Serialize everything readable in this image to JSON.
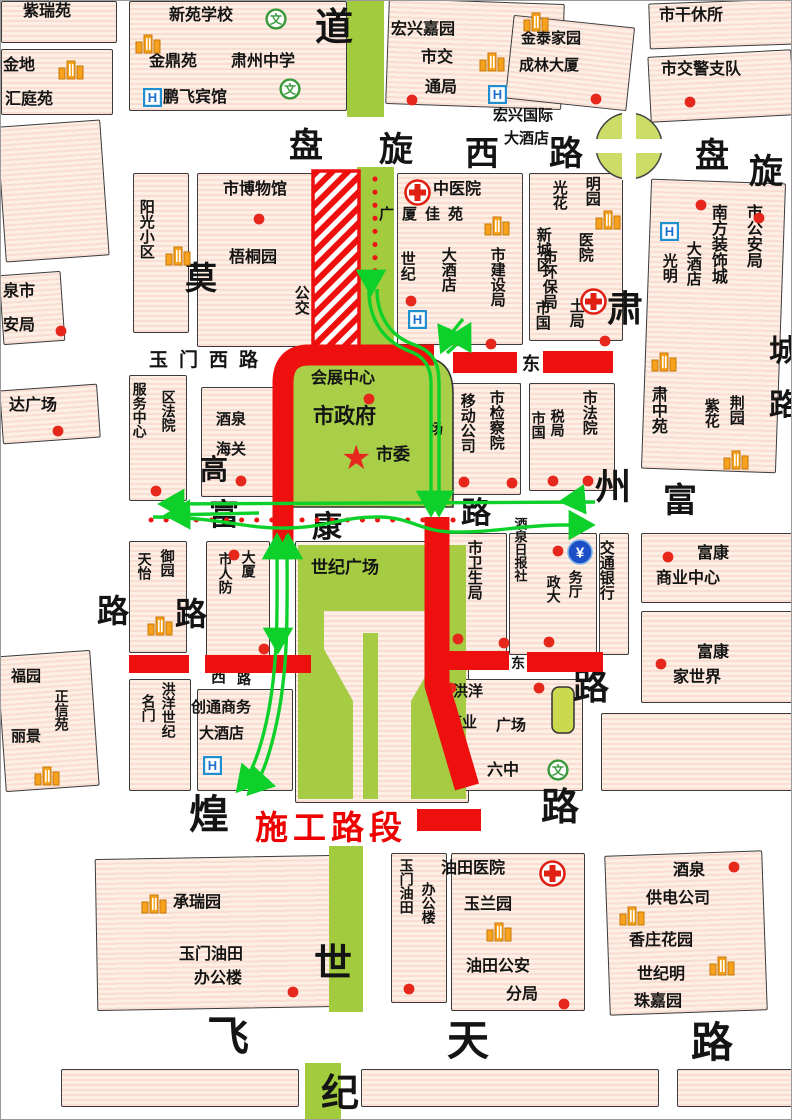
{
  "legend": {
    "label": "施工路段"
  },
  "colors": {
    "construction": "#ee0f0f",
    "detour": "#0ed02a",
    "block_fill": "#fdefe4",
    "green_area": "#a6cc44",
    "poi_dot": "#e5281b"
  },
  "map": {
    "labels": [
      {
        "t": "紫瑞苑",
        "x": 22,
        "y": 2,
        "s": 16
      },
      {
        "t": "金地",
        "x": 2,
        "y": 56,
        "s": 16
      },
      {
        "t": "汇庭苑",
        "x": 4,
        "y": 90,
        "s": 16
      },
      {
        "t": "新苑学校",
        "x": 168,
        "y": 6,
        "s": 16
      },
      {
        "t": "金鼎苑",
        "x": 148,
        "y": 52,
        "s": 16
      },
      {
        "t": "肃州中学",
        "x": 230,
        "y": 52,
        "s": 16
      },
      {
        "t": "鹏飞宾馆",
        "x": 162,
        "y": 88,
        "s": 16
      },
      {
        "t": "宏兴嘉园",
        "x": 390,
        "y": 20,
        "s": 16
      },
      {
        "t": "市交",
        "x": 420,
        "y": 48,
        "s": 16
      },
      {
        "t": "通局",
        "x": 424,
        "y": 78,
        "s": 16
      },
      {
        "t": "金泰家园",
        "x": 520,
        "y": 30,
        "s": 15
      },
      {
        "t": "成林大厦",
        "x": 518,
        "y": 57,
        "s": 15
      },
      {
        "t": "市干休所",
        "x": 658,
        "y": 6,
        "s": 16
      },
      {
        "t": "市交警支队",
        "x": 660,
        "y": 60,
        "s": 16
      },
      {
        "t": "宏兴国际",
        "x": 492,
        "y": 107,
        "s": 15
      },
      {
        "t": "大酒店",
        "x": 503,
        "y": 130,
        "s": 15
      },
      {
        "t": "道",
        "x": 314,
        "y": 6,
        "s": 38
      },
      {
        "t": "盘",
        "x": 288,
        "y": 126,
        "s": 34
      },
      {
        "t": "旋",
        "x": 378,
        "y": 130,
        "s": 34
      },
      {
        "t": "西",
        "x": 464,
        "y": 134,
        "s": 34
      },
      {
        "t": "路",
        "x": 548,
        "y": 134,
        "s": 34
      },
      {
        "t": "盘",
        "x": 694,
        "y": 136,
        "s": 34
      },
      {
        "t": "旋",
        "x": 748,
        "y": 152,
        "s": 34
      },
      {
        "t": "市博物馆",
        "x": 222,
        "y": 180,
        "s": 16
      },
      {
        "t": "阳光小区",
        "x": 136,
        "y": 198,
        "s": 15,
        "v": 1
      },
      {
        "t": "梧桐园",
        "x": 228,
        "y": 248,
        "s": 16
      },
      {
        "t": "莫",
        "x": 184,
        "y": 260,
        "s": 32
      },
      {
        "t": "公交",
        "x": 291,
        "y": 284,
        "s": 15,
        "v": 1
      },
      {
        "t": "资中",
        "x": 339,
        "y": 284,
        "s": 15,
        "v": 1
      },
      {
        "t": "中医院",
        "x": 432,
        "y": 180,
        "s": 16
      },
      {
        "t": "广厦佳苑",
        "x": 378,
        "y": 206,
        "s": 15,
        "ls": 8
      },
      {
        "t": "世纪",
        "x": 397,
        "y": 250,
        "s": 15,
        "v": 1
      },
      {
        "t": "大酒店",
        "x": 438,
        "y": 246,
        "s": 15,
        "v": 1
      },
      {
        "t": "市建设局",
        "x": 487,
        "y": 246,
        "s": 15,
        "v": 1
      },
      {
        "t": "市环保局",
        "x": 539,
        "y": 248,
        "s": 15,
        "v": 1
      },
      {
        "t": "明园",
        "x": 582,
        "y": 175,
        "s": 15,
        "v": 1
      },
      {
        "t": "光花",
        "x": 549,
        "y": 179,
        "s": 15,
        "v": 1
      },
      {
        "t": "医院",
        "x": 575,
        "y": 231,
        "s": 15,
        "v": 1
      },
      {
        "t": "新城区",
        "x": 533,
        "y": 226,
        "s": 15,
        "v": 1
      },
      {
        "t": "土局",
        "x": 566,
        "y": 297,
        "s": 15,
        "v": 1
      },
      {
        "t": "市国",
        "x": 532,
        "y": 299,
        "s": 15,
        "v": 1
      },
      {
        "t": "市公安局",
        "x": 742,
        "y": 203,
        "s": 16,
        "v": 1
      },
      {
        "t": "南方装饰城",
        "x": 707,
        "y": 203,
        "s": 16,
        "v": 1
      },
      {
        "t": "大酒店",
        "x": 683,
        "y": 240,
        "s": 15,
        "v": 1
      },
      {
        "t": "光明",
        "x": 659,
        "y": 252,
        "s": 15,
        "v": 1
      },
      {
        "t": "肃中苑",
        "x": 647,
        "y": 385,
        "s": 16,
        "v": 1
      },
      {
        "t": "荆园",
        "x": 726,
        "y": 394,
        "s": 15,
        "v": 1
      },
      {
        "t": "紫花",
        "x": 701,
        "y": 397,
        "s": 15,
        "v": 1
      },
      {
        "t": "城",
        "x": 768,
        "y": 334,
        "s": 30
      },
      {
        "t": "路",
        "x": 768,
        "y": 388,
        "s": 30
      },
      {
        "t": "肃",
        "x": 606,
        "y": 288,
        "s": 36
      },
      {
        "t": "州",
        "x": 594,
        "y": 466,
        "s": 36
      },
      {
        "t": "路",
        "x": 572,
        "y": 666,
        "s": 36
      },
      {
        "t": "富",
        "x": 662,
        "y": 481,
        "s": 34
      },
      {
        "t": "玉门西路",
        "x": 148,
        "y": 349,
        "s": 19,
        "ls": 11
      },
      {
        "t": "东",
        "x": 521,
        "y": 353,
        "s": 18
      },
      {
        "t": "泉市",
        "x": 2,
        "y": 282,
        "s": 16
      },
      {
        "t": "安局",
        "x": 2,
        "y": 316,
        "s": 16
      },
      {
        "t": "达广场",
        "x": 8,
        "y": 396,
        "s": 16
      },
      {
        "t": "服务中心",
        "x": 130,
        "y": 381,
        "s": 14,
        "v": 1
      },
      {
        "t": "区法院",
        "x": 159,
        "y": 389,
        "s": 14,
        "v": 1
      },
      {
        "t": "酒泉",
        "x": 215,
        "y": 411,
        "s": 15
      },
      {
        "t": "海关",
        "x": 215,
        "y": 441,
        "s": 15
      },
      {
        "t": "会展中心",
        "x": 310,
        "y": 369,
        "s": 16
      },
      {
        "t": "市政府",
        "x": 312,
        "y": 404,
        "s": 21
      },
      {
        "t": "市委",
        "x": 375,
        "y": 444,
        "s": 17
      },
      {
        "t": "场",
        "x": 428,
        "y": 421,
        "s": 14
      },
      {
        "t": "移动公司",
        "x": 457,
        "y": 392,
        "s": 15,
        "v": 1
      },
      {
        "t": "市检察院",
        "x": 486,
        "y": 389,
        "s": 15,
        "v": 1
      },
      {
        "t": "市国",
        "x": 529,
        "y": 410,
        "s": 14,
        "v": 1
      },
      {
        "t": "税局",
        "x": 548,
        "y": 408,
        "s": 14,
        "v": 1
      },
      {
        "t": "市法院",
        "x": 579,
        "y": 389,
        "s": 15,
        "v": 1
      },
      {
        "t": "富",
        "x": 208,
        "y": 498,
        "s": 30
      },
      {
        "t": "康",
        "x": 311,
        "y": 510,
        "s": 30
      },
      {
        "t": "路",
        "x": 460,
        "y": 496,
        "s": 30
      },
      {
        "t": "酒泉日报社",
        "x": 511,
        "y": 516,
        "s": 13,
        "v": 1
      },
      {
        "t": "天怡",
        "x": 135,
        "y": 551,
        "s": 14,
        "v": 1
      },
      {
        "t": "御园",
        "x": 158,
        "y": 548,
        "s": 14,
        "v": 1
      },
      {
        "t": "市人防",
        "x": 216,
        "y": 551,
        "s": 14,
        "v": 1
      },
      {
        "t": "大厦",
        "x": 239,
        "y": 549,
        "s": 14,
        "v": 1
      },
      {
        "t": "世纪广场",
        "x": 310,
        "y": 557,
        "s": 17
      },
      {
        "t": "高",
        "x": 199,
        "y": 453,
        "s": 28
      },
      {
        "t": "路",
        "x": 174,
        "y": 596,
        "s": 32
      },
      {
        "t": "路",
        "x": 96,
        "y": 593,
        "s": 32
      },
      {
        "t": "市卫生局",
        "x": 464,
        "y": 539,
        "s": 15,
        "v": 1
      },
      {
        "t": "政大",
        "x": 544,
        "y": 574,
        "s": 14,
        "v": 1
      },
      {
        "t": "务厅",
        "x": 566,
        "y": 569,
        "s": 14,
        "v": 1
      },
      {
        "t": "交通银行",
        "x": 596,
        "y": 539,
        "s": 15,
        "v": 1
      },
      {
        "t": "富康",
        "x": 696,
        "y": 544,
        "s": 16
      },
      {
        "t": "商业中心",
        "x": 655,
        "y": 569,
        "s": 16
      },
      {
        "t": "富康",
        "x": 696,
        "y": 643,
        "s": 16
      },
      {
        "t": "家世界",
        "x": 672,
        "y": 668,
        "s": 16
      },
      {
        "t": "西",
        "x": 210,
        "y": 669,
        "s": 15
      },
      {
        "t": "路",
        "x": 236,
        "y": 671,
        "s": 14
      },
      {
        "t": "东",
        "x": 510,
        "y": 655,
        "s": 14
      },
      {
        "t": "名门",
        "x": 139,
        "y": 693,
        "s": 14,
        "v": 1
      },
      {
        "t": "洪洋世纪",
        "x": 159,
        "y": 681,
        "s": 14,
        "v": 1
      },
      {
        "t": "创通商务",
        "x": 190,
        "y": 699,
        "s": 15
      },
      {
        "t": "大酒店",
        "x": 198,
        "y": 725,
        "s": 15
      },
      {
        "t": "洪洋",
        "x": 452,
        "y": 683,
        "s": 15
      },
      {
        "t": "商业",
        "x": 446,
        "y": 714,
        "s": 15
      },
      {
        "t": "广场",
        "x": 495,
        "y": 717,
        "s": 15
      },
      {
        "t": "六中",
        "x": 486,
        "y": 761,
        "s": 16
      },
      {
        "t": "煌",
        "x": 188,
        "y": 792,
        "s": 40
      },
      {
        "t": "路",
        "x": 540,
        "y": 786,
        "s": 38
      },
      {
        "t": "承瑞园",
        "x": 172,
        "y": 893,
        "s": 16
      },
      {
        "t": "玉门油田",
        "x": 178,
        "y": 945,
        "s": 16
      },
      {
        "t": "办公楼",
        "x": 193,
        "y": 969,
        "s": 16
      },
      {
        "t": "世",
        "x": 313,
        "y": 942,
        "s": 38
      },
      {
        "t": "纪",
        "x": 320,
        "y": 1072,
        "s": 38
      },
      {
        "t": "玉门油田",
        "x": 397,
        "y": 857,
        "s": 14,
        "v": 1
      },
      {
        "t": "办公楼",
        "x": 419,
        "y": 881,
        "s": 14,
        "v": 1
      },
      {
        "t": "油田医院",
        "x": 440,
        "y": 859,
        "s": 16
      },
      {
        "t": "玉兰园",
        "x": 463,
        "y": 895,
        "s": 16
      },
      {
        "t": "油田公安",
        "x": 465,
        "y": 957,
        "s": 16
      },
      {
        "t": "分局",
        "x": 505,
        "y": 985,
        "s": 16
      },
      {
        "t": "酒泉",
        "x": 672,
        "y": 861,
        "s": 16
      },
      {
        "t": "供电公司",
        "x": 645,
        "y": 889,
        "s": 16
      },
      {
        "t": "香庄花园",
        "x": 628,
        "y": 931,
        "s": 16
      },
      {
        "t": "世纪明",
        "x": 636,
        "y": 965,
        "s": 16
      },
      {
        "t": "珠嘉园",
        "x": 633,
        "y": 992,
        "s": 16
      },
      {
        "t": "飞",
        "x": 206,
        "y": 1012,
        "s": 42
      },
      {
        "t": "天",
        "x": 446,
        "y": 1016,
        "s": 42
      },
      {
        "t": "路",
        "x": 690,
        "y": 1018,
        "s": 42
      },
      {
        "t": "福园",
        "x": 10,
        "y": 668,
        "s": 15
      },
      {
        "t": "正信苑",
        "x": 52,
        "y": 688,
        "s": 14,
        "v": 1
      },
      {
        "t": "丽景",
        "x": 10,
        "y": 728,
        "s": 15
      }
    ],
    "icons": [
      {
        "k": "building",
        "x": 57,
        "y": 58
      },
      {
        "k": "building",
        "x": 134,
        "y": 32
      },
      {
        "k": "building",
        "x": 478,
        "y": 50
      },
      {
        "k": "building",
        "x": 522,
        "y": 10
      },
      {
        "k": "building",
        "x": 164,
        "y": 244
      },
      {
        "k": "building",
        "x": 594,
        "y": 208
      },
      {
        "k": "building",
        "x": 483,
        "y": 214
      },
      {
        "k": "building",
        "x": 650,
        "y": 350
      },
      {
        "k": "building",
        "x": 722,
        "y": 448
      },
      {
        "k": "building",
        "x": 146,
        "y": 614
      },
      {
        "k": "building",
        "x": 33,
        "y": 764
      },
      {
        "k": "building",
        "x": 140,
        "y": 892
      },
      {
        "k": "building",
        "x": 485,
        "y": 920
      },
      {
        "k": "building",
        "x": 618,
        "y": 904
      },
      {
        "k": "building",
        "x": 708,
        "y": 954
      },
      {
        "k": "hotel",
        "x": 142,
        "y": 87
      },
      {
        "k": "hotel",
        "x": 487,
        "y": 84
      },
      {
        "k": "hotel",
        "x": 407,
        "y": 309
      },
      {
        "k": "hotel",
        "x": 659,
        "y": 221
      },
      {
        "k": "hotel",
        "x": 202,
        "y": 755
      },
      {
        "k": "school",
        "x": 264,
        "y": 7
      },
      {
        "k": "school",
        "x": 278,
        "y": 77
      },
      {
        "k": "school",
        "x": 546,
        "y": 758
      },
      {
        "k": "bank",
        "x": 566,
        "y": 538
      },
      {
        "k": "cross",
        "x": 403,
        "y": 178
      },
      {
        "k": "cross",
        "x": 579,
        "y": 287
      },
      {
        "k": "cross",
        "x": 538,
        "y": 859
      },
      {
        "k": "star",
        "x": 340,
        "y": 440
      },
      {
        "k": "dot",
        "x": 405,
        "y": 93
      },
      {
        "k": "dot",
        "x": 589,
        "y": 92
      },
      {
        "k": "dot",
        "x": 683,
        "y": 95
      },
      {
        "k": "dot",
        "x": 252,
        "y": 212
      },
      {
        "k": "dot",
        "x": 694,
        "y": 198
      },
      {
        "k": "dot",
        "x": 752,
        "y": 211
      },
      {
        "k": "dot",
        "x": 598,
        "y": 334
      },
      {
        "k": "dot",
        "x": 404,
        "y": 294
      },
      {
        "k": "dot",
        "x": 449,
        "y": 334
      },
      {
        "k": "dot",
        "x": 484,
        "y": 337
      },
      {
        "k": "dot",
        "x": 54,
        "y": 324
      },
      {
        "k": "dot",
        "x": 149,
        "y": 484
      },
      {
        "k": "dot",
        "x": 51,
        "y": 424
      },
      {
        "k": "dot",
        "x": 234,
        "y": 474
      },
      {
        "k": "dot",
        "x": 362,
        "y": 392
      },
      {
        "k": "dot",
        "x": 457,
        "y": 475
      },
      {
        "k": "dot",
        "x": 505,
        "y": 476
      },
      {
        "k": "dot",
        "x": 546,
        "y": 474
      },
      {
        "k": "dot",
        "x": 581,
        "y": 474
      },
      {
        "k": "dot",
        "x": 227,
        "y": 548
      },
      {
        "k": "dot",
        "x": 257,
        "y": 642
      },
      {
        "k": "dot",
        "x": 451,
        "y": 632
      },
      {
        "k": "dot",
        "x": 497,
        "y": 636
      },
      {
        "k": "dot",
        "x": 551,
        "y": 544
      },
      {
        "k": "dot",
        "x": 542,
        "y": 635
      },
      {
        "k": "dot",
        "x": 661,
        "y": 550
      },
      {
        "k": "dot",
        "x": 654,
        "y": 657
      },
      {
        "k": "dot",
        "x": 444,
        "y": 681
      },
      {
        "k": "dot",
        "x": 532,
        "y": 681
      },
      {
        "k": "dot",
        "x": 286,
        "y": 985
      },
      {
        "k": "dot",
        "x": 402,
        "y": 982
      },
      {
        "k": "dot",
        "x": 557,
        "y": 997
      },
      {
        "k": "dot",
        "x": 727,
        "y": 860
      }
    ]
  }
}
